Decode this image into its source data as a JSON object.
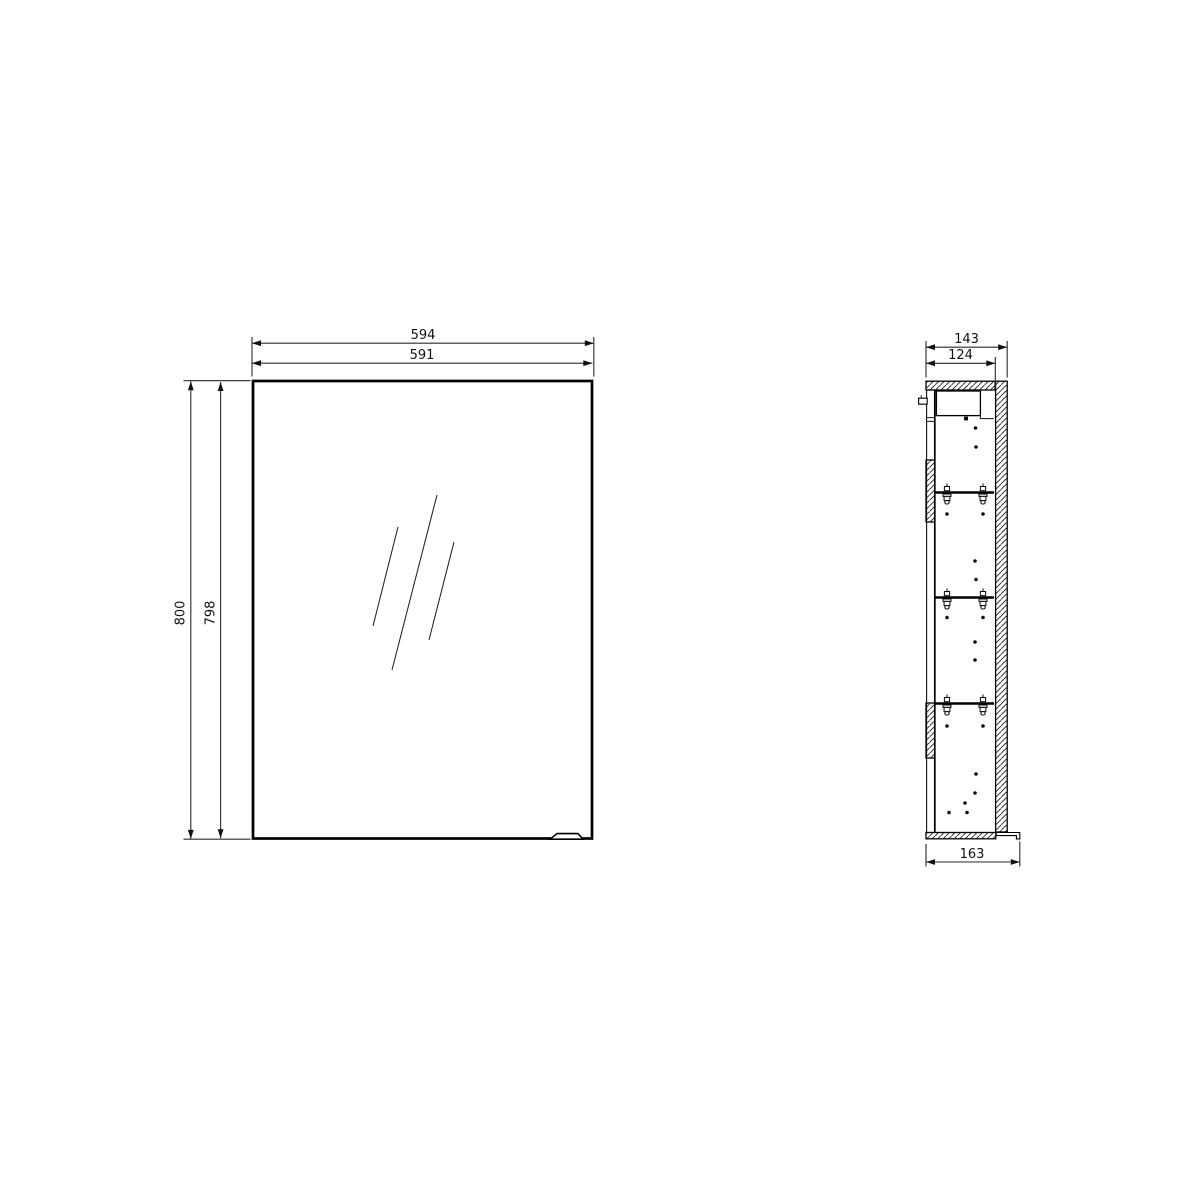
{
  "front_view": {
    "width_outer": "594",
    "width_inner": "591",
    "height_outer": "800",
    "height_inner": "798"
  },
  "side_view": {
    "depth_outer": "143",
    "depth_inner": "124",
    "depth_with_handle": "163"
  }
}
